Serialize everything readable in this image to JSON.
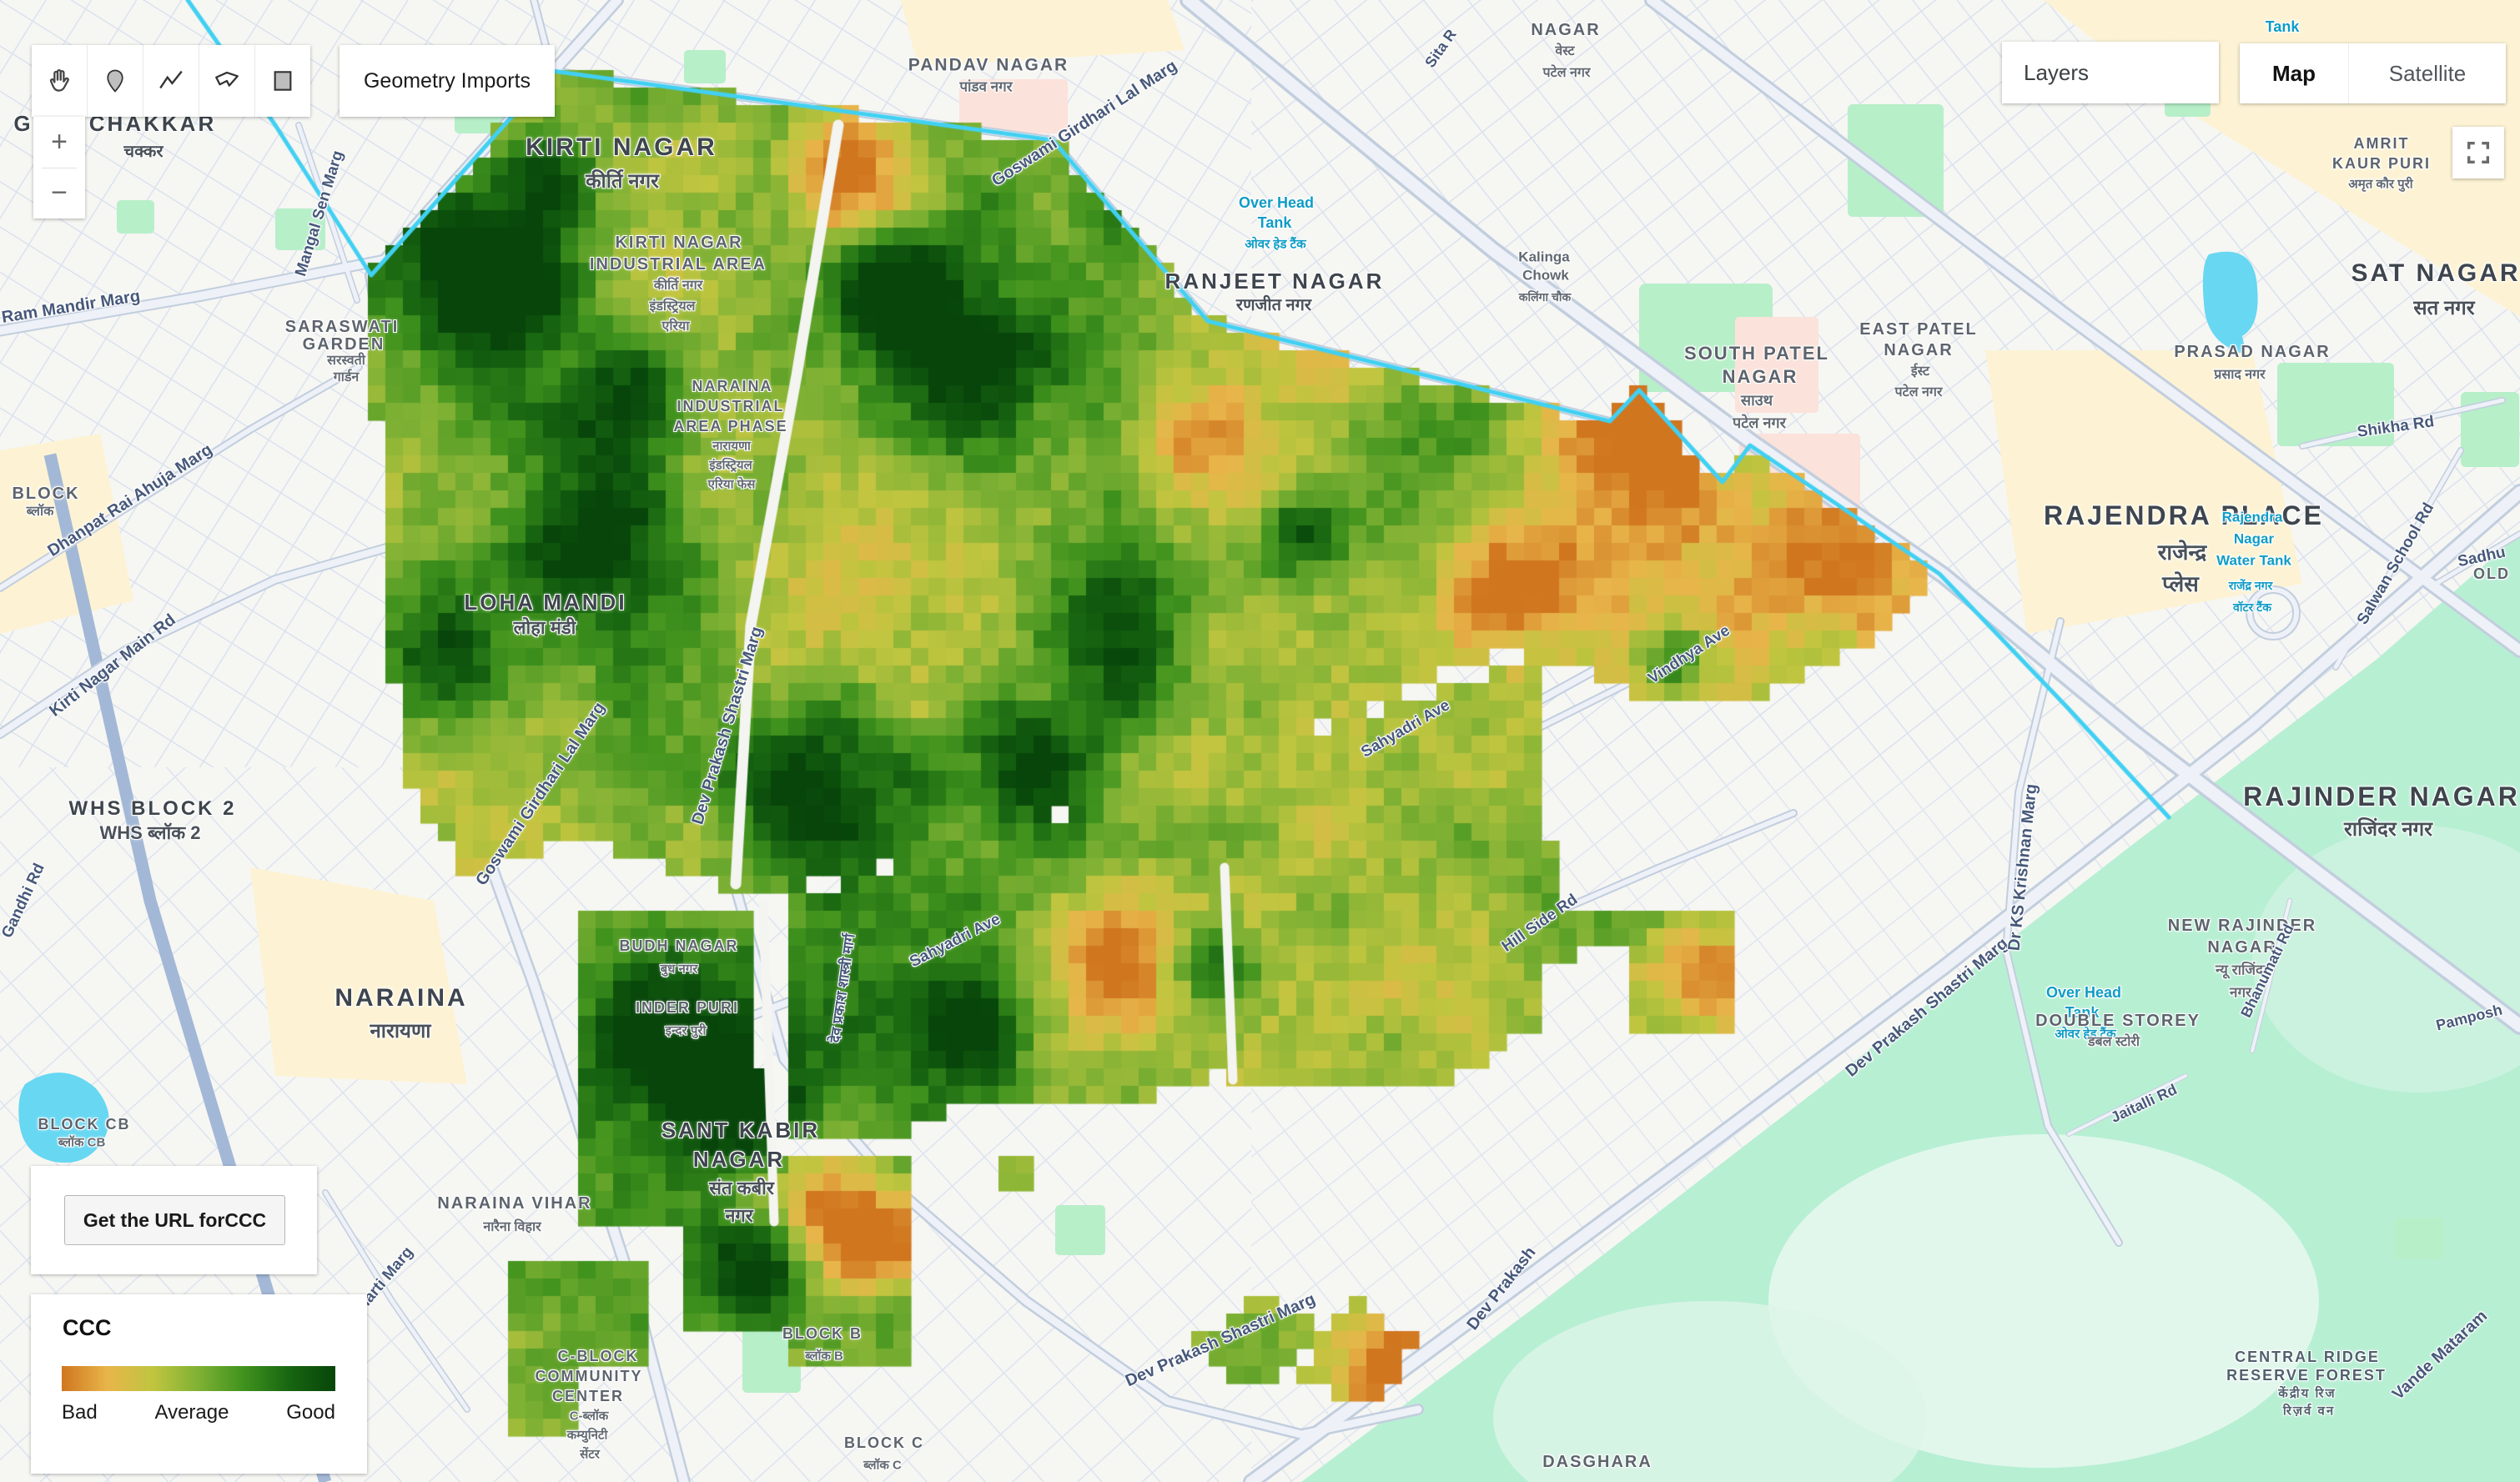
{
  "toolbar": {
    "geometry_imports_label": "Geometry Imports",
    "tools": [
      "pan-hand",
      "point-marker",
      "polyline",
      "polygon",
      "rectangle"
    ]
  },
  "zoom_control": {
    "zoom_in_label": "+",
    "zoom_out_label": "−"
  },
  "layers_panel": {
    "label": "Layers"
  },
  "basemap_toggle": {
    "map_label": "Map",
    "satellite_label": "Satellite",
    "active": "Map"
  },
  "url_panel": {
    "button_label": "Get the URL forCCC"
  },
  "legend": {
    "title": "CCC",
    "min_label": "Bad",
    "mid_label": "Average",
    "max_label": "Good",
    "gradient_colors": [
      "#d0761f",
      "#e8b54a",
      "#c0c53f",
      "#7fb134",
      "#3f921d",
      "#176511",
      "#07450a"
    ]
  },
  "raster_layer": {
    "name": "CCC"
  },
  "map": {
    "labels": [
      [
        "G",
        28,
        148,
        26,
        "A",
        0
      ],
      [
        "CHAKKAR",
        183,
        148,
        26,
        "A",
        0
      ],
      [
        "चक्कर",
        172,
        182,
        20,
        "H",
        0
      ],
      [
        "KIRTI NAGAR",
        745,
        177,
        30,
        "A",
        0
      ],
      [
        "कीर्ति नगर",
        746,
        218,
        24,
        "H",
        0
      ],
      [
        "PANDAV NAGAR",
        1185,
        78,
        21,
        "a",
        0
      ],
      [
        "पांडव नगर",
        1182,
        104,
        17,
        "h",
        0
      ],
      [
        "KIRTI NAGAR",
        814,
        291,
        20,
        "a",
        0
      ],
      [
        "INDUSTRIAL AREA",
        813,
        317,
        20,
        "a",
        0
      ],
      [
        "कीर्ति नगर",
        813,
        343,
        16,
        "h",
        0
      ],
      [
        "इंडस्ट्रियल",
        806,
        368,
        16,
        "h",
        0
      ],
      [
        "एरिया",
        810,
        392,
        16,
        "h",
        0
      ],
      [
        "NARAINA",
        878,
        463,
        18,
        "a",
        0
      ],
      [
        "INDUSTRIAL",
        876,
        487,
        18,
        "a",
        0
      ],
      [
        "AREA PHASE",
        876,
        511,
        18,
        "a",
        0
      ],
      [
        "नारायणा",
        877,
        535,
        15,
        "h",
        0
      ],
      [
        "इंडस्ट्रियल",
        876,
        558,
        15,
        "h",
        0
      ],
      [
        "एरिया फेस",
        877,
        581,
        15,
        "h",
        0
      ],
      [
        "SARASWATI",
        410,
        392,
        20,
        "a",
        0
      ],
      [
        "GARDEN",
        412,
        413,
        20,
        "a",
        0
      ],
      [
        "सरस्वती",
        415,
        433,
        16,
        "h",
        0
      ],
      [
        "गार्डन",
        415,
        453,
        16,
        "h",
        0
      ],
      [
        "RANJEET NAGAR",
        1528,
        337,
        26,
        "A",
        0
      ],
      [
        "रणजीत नगर",
        1527,
        366,
        20,
        "H",
        0
      ],
      [
        "Over Head",
        1530,
        243,
        18,
        "w",
        0
      ],
      [
        "Tank",
        1528,
        267,
        18,
        "w",
        0
      ],
      [
        "ओवर हेड टैंक",
        1529,
        293,
        15,
        "w",
        0
      ],
      [
        "Kalinga",
        1851,
        308,
        17,
        "p",
        0
      ],
      [
        "Chowk",
        1853,
        330,
        17,
        "p",
        0
      ],
      [
        "कलिंगा चौक",
        1852,
        356,
        14,
        "p",
        0
      ],
      [
        "NAGAR",
        1877,
        36,
        20,
        "a",
        0
      ],
      [
        "वेस्ट",
        1876,
        62,
        16,
        "h",
        0
      ],
      [
        "पटेल नगर",
        1878,
        88,
        16,
        "h",
        0
      ],
      [
        "Sita R",
        1727,
        58,
        18,
        "r",
        -55
      ],
      [
        "Tank",
        2736,
        32,
        18,
        "w",
        0
      ],
      [
        "EAST PATEL",
        2300,
        395,
        20,
        "a",
        0
      ],
      [
        "NAGAR",
        2300,
        420,
        20,
        "a",
        0
      ],
      [
        "ईस्ट",
        2302,
        446,
        16,
        "h",
        0
      ],
      [
        "पटेल नगर",
        2300,
        471,
        16,
        "h",
        0
      ],
      [
        "SOUTH PATEL",
        2106,
        424,
        22,
        "a",
        0
      ],
      [
        "NAGAR",
        2110,
        452,
        22,
        "a",
        0
      ],
      [
        "साउथ",
        2106,
        480,
        18,
        "h",
        0
      ],
      [
        "पटेल नगर",
        2109,
        507,
        18,
        "h",
        0
      ],
      [
        "AMRIT",
        2855,
        172,
        18,
        "a",
        0
      ],
      [
        "KAUR PURI",
        2855,
        196,
        18,
        "a",
        0
      ],
      [
        "अमृत कौर पुरी",
        2854,
        221,
        15,
        "h",
        0
      ],
      [
        "SAT NAGAR",
        2920,
        328,
        30,
        "A",
        0
      ],
      [
        "सत नगर",
        2930,
        370,
        24,
        "H",
        0
      ],
      [
        "PRASAD NAGAR",
        2700,
        422,
        20,
        "a",
        0
      ],
      [
        "प्रसाद नगर",
        2685,
        450,
        16,
        "h",
        0
      ],
      [
        "Shikha Rd",
        2872,
        512,
        19,
        "r",
        -8
      ],
      [
        "RAJENDRA PLACE",
        2618,
        618,
        32,
        "A",
        0
      ],
      [
        "राजेन्द्र",
        2616,
        662,
        26,
        "H",
        0
      ],
      [
        "प्लेस",
        2614,
        700,
        26,
        "H",
        0
      ],
      [
        "Sadhu",
        2975,
        668,
        19,
        "r",
        -12
      ],
      [
        "Rajendra",
        2700,
        620,
        17,
        "w",
        0
      ],
      [
        "Nagar",
        2702,
        646,
        17,
        "w",
        0
      ],
      [
        "Water Tank",
        2702,
        672,
        17,
        "w",
        0
      ],
      [
        "राजेंद्र नगर",
        2698,
        702,
        14,
        "w",
        0
      ],
      [
        "वॉटर टैंक",
        2700,
        728,
        14,
        "w",
        0
      ],
      [
        "Salwan School Rd",
        2872,
        676,
        19,
        "r",
        -60
      ],
      [
        "OLD",
        2987,
        688,
        18,
        "a",
        0
      ],
      [
        "Goswami Girdhari Lal Marg",
        1300,
        148,
        20,
        "r",
        -33
      ],
      [
        "Goswami Girdhari Lal Marg",
        648,
        952,
        20,
        "r",
        -56
      ],
      [
        "Dev Prakash Shastri Marg",
        872,
        870,
        20,
        "r",
        -73
      ],
      [
        "देव प्रकाश शास्त्री मार्ग",
        1010,
        1185,
        17,
        "r",
        -82
      ],
      [
        "Dev Prakash Shastri Marg",
        1463,
        1607,
        20,
        "r",
        -24
      ],
      [
        "Dev Prakash",
        1800,
        1545,
        20,
        "r",
        -52
      ],
      [
        "Dev Prakash Shastri Marg",
        2310,
        1208,
        20,
        "r",
        -40
      ],
      [
        "Sahyadri Ave",
        1685,
        874,
        19,
        "r",
        -30
      ],
      [
        "Sahyadri Ave",
        1145,
        1128,
        19,
        "r",
        -27
      ],
      [
        "Vindhya Ave",
        2025,
        785,
        19,
        "r",
        -33
      ],
      [
        "Hill Side Rd",
        1846,
        1107,
        19,
        "r",
        -35
      ],
      [
        "Mangal Sen Marg",
        383,
        256,
        19,
        "r",
        -73
      ],
      [
        "Ram Mandir Marg",
        85,
        368,
        20,
        "r",
        -9
      ],
      [
        "Dhanpat Rai Ahuja Marg",
        156,
        600,
        20,
        "r",
        -33
      ],
      [
        "Kirti Nagar Main Rd",
        135,
        798,
        20,
        "r",
        -38
      ],
      [
        "Gandhi Rd",
        28,
        1080,
        19,
        "r",
        -65
      ],
      [
        "BLOCK",
        55,
        592,
        20,
        "a",
        0
      ],
      [
        "ब्लॉक",
        48,
        614,
        16,
        "h",
        0
      ],
      [
        "WHS BLOCK 2",
        183,
        970,
        24,
        "A",
        0
      ],
      [
        "WHS ब्लॉक 2",
        180,
        999,
        22,
        "H",
        0
      ],
      [
        "LOHA MANDI",
        654,
        722,
        26,
        "A",
        0
      ],
      [
        "लोहा मंडी",
        653,
        753,
        22,
        "H",
        0
      ],
      [
        "NARAINA",
        481,
        1197,
        30,
        "A",
        0
      ],
      [
        "नारायणा",
        480,
        1237,
        24,
        "H",
        0
      ],
      [
        "BUDH NAGAR",
        814,
        1134,
        18,
        "a",
        0
      ],
      [
        "बुध नगर",
        814,
        1162,
        15,
        "h",
        0
      ],
      [
        "INDER PURI",
        824,
        1208,
        18,
        "a",
        0
      ],
      [
        "इन्दर पुरी",
        822,
        1236,
        15,
        "h",
        0
      ],
      [
        "SANT KABIR",
        888,
        1355,
        26,
        "A",
        0
      ],
      [
        "NAGAR",
        886,
        1390,
        26,
        "A",
        0
      ],
      [
        "संत कबीर",
        889,
        1425,
        22,
        "H",
        0
      ],
      [
        "नगर",
        886,
        1458,
        22,
        "H",
        0
      ],
      [
        "NARAINA VIHAR",
        617,
        1443,
        20,
        "a",
        0
      ],
      [
        "नारैना विहार",
        614,
        1472,
        16,
        "h",
        0
      ],
      [
        "C-BLOCK",
        717,
        1626,
        18,
        "a",
        0
      ],
      [
        "COMMUNITY",
        706,
        1650,
        18,
        "a",
        0
      ],
      [
        "CENTER",
        705,
        1674,
        18,
        "a",
        0
      ],
      [
        "C-ब्लॉक",
        706,
        1698,
        15,
        "h",
        0
      ],
      [
        "कम्युनिटी",
        704,
        1721,
        15,
        "h",
        0
      ],
      [
        "सेंटर",
        707,
        1744,
        15,
        "h",
        0
      ],
      [
        "BLOCK B",
        986,
        1599,
        18,
        "a",
        0
      ],
      [
        "ब्लॉक B",
        988,
        1626,
        15,
        "h",
        0
      ],
      [
        "BLOCK C",
        1060,
        1730,
        18,
        "a",
        0
      ],
      [
        "ब्लॉक C",
        1058,
        1757,
        15,
        "h",
        0
      ],
      [
        "BLOCK CB",
        101,
        1348,
        18,
        "a",
        0
      ],
      [
        "ब्लॉक CB",
        98,
        1370,
        15,
        "h",
        0
      ],
      [
        "P Bharti Marg",
        452,
        1545,
        19,
        "r",
        -50
      ],
      [
        "Dr KS Krishnan Marg",
        2425,
        1040,
        20,
        "r",
        -84
      ],
      [
        "RAJINDER NAGAR",
        2855,
        955,
        32,
        "A",
        0
      ],
      [
        "राजिंदर नगर",
        2863,
        995,
        24,
        "H",
        0
      ],
      [
        "NEW RAJINDER",
        2688,
        1110,
        20,
        "a",
        0
      ],
      [
        "NAGAR",
        2688,
        1136,
        20,
        "a",
        0
      ],
      [
        "न्यू राजिंदर",
        2688,
        1163,
        17,
        "h",
        0
      ],
      [
        "नगर",
        2686,
        1190,
        17,
        "h",
        0
      ],
      [
        "Over Head",
        2498,
        1190,
        18,
        "w",
        0
      ],
      [
        "Tank",
        2496,
        1214,
        18,
        "w",
        0
      ],
      [
        "ओवर हेड टैंक",
        2500,
        1240,
        15,
        "w",
        0
      ],
      [
        "Pamposh",
        2960,
        1220,
        18,
        "r",
        -14
      ],
      [
        "DOUBLE STOREY",
        2539,
        1224,
        20,
        "a",
        0
      ],
      [
        "डबल स्टोरी",
        2534,
        1250,
        16,
        "h",
        0
      ],
      [
        "Jaitalli Rd",
        2570,
        1323,
        18,
        "r",
        -25
      ],
      [
        "Bhanumati Rd",
        2718,
        1164,
        18,
        "r",
        -64
      ],
      [
        "Vande Mataram",
        2925,
        1625,
        20,
        "r",
        -43
      ],
      [
        "CENTRAL RIDGE",
        2766,
        1627,
        18,
        "f",
        0
      ],
      [
        "RESERVE FOREST",
        2765,
        1649,
        18,
        "f",
        0
      ],
      [
        "केंद्रीय रिज",
        2766,
        1671,
        15,
        "f",
        0
      ],
      [
        "रिज़र्व वन",
        2768,
        1692,
        15,
        "f",
        0
      ],
      [
        "DASGHARA",
        1915,
        1753,
        20,
        "a",
        0
      ]
    ]
  }
}
